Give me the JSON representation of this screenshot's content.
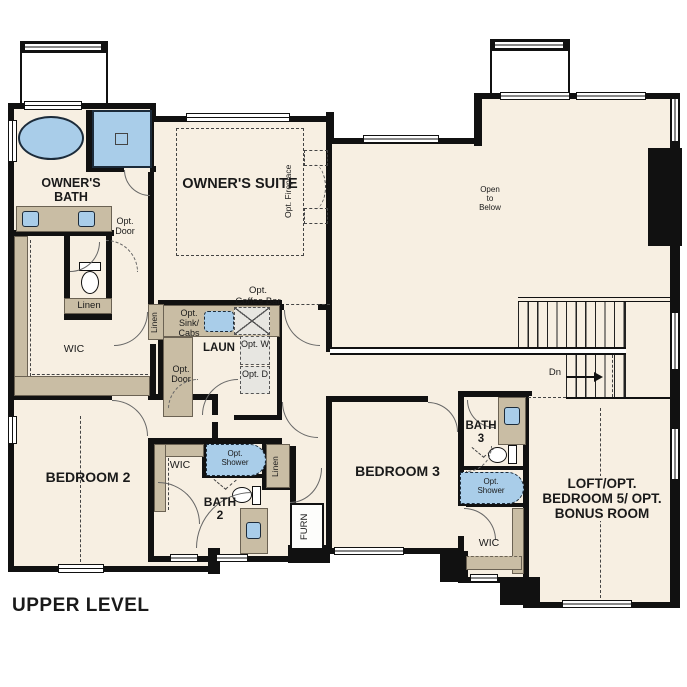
{
  "title": "UPPER LEVEL",
  "labels": {
    "owners_bath": "OWNER'S BATH",
    "owners_suite": "OWNER'S SUITE",
    "opt_fireplace": "Opt. Fireplace",
    "open_to_below": "Open to Below",
    "opt_door": "Opt. Door",
    "linen": "Linen",
    "wic": "WIC",
    "opt_sink_cabs": "Opt. Sink/ Cabs",
    "laun": "LAUN",
    "opt_coffee_bar": "Opt. Coffee Bar",
    "opt_w": "Opt. W",
    "opt_d": "Opt. D",
    "opt_shower": "Opt. Shower",
    "bedroom2": "BEDROOM 2",
    "bath2": "BATH 2",
    "bedroom3": "BEDROOM 3",
    "bath3": "BATH 3",
    "furn": "FURN",
    "loft": "LOFT/OPT. BEDROOM 5/ OPT. BONUS ROOM",
    "dn": "Dn"
  },
  "colors": {
    "floor": "#f7efe2",
    "wall": "#111111",
    "cabinet": "#c9bda4",
    "fixture_blue": "#a9cde9",
    "window": "#ffffff",
    "dashed_line": "#444444"
  }
}
